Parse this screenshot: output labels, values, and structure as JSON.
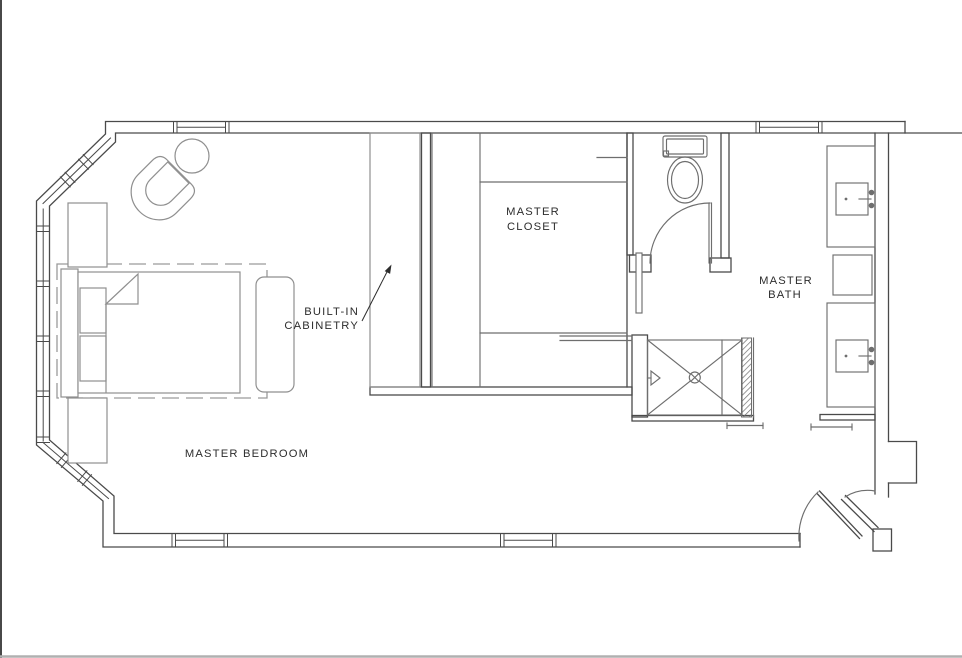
{
  "drawing": {
    "type": "architectural floor plan",
    "rooms": [
      {
        "name": "master-bedroom",
        "label": "MASTER BEDROOM"
      },
      {
        "name": "master-closet",
        "line1": "MASTER",
        "line2": "CLOSET"
      },
      {
        "name": "master-bath",
        "line1": "MASTER",
        "line2": "BATH"
      }
    ],
    "callouts": [
      {
        "name": "built-in-cabinetry",
        "line1": "BUILT-IN",
        "line2": "CABINETRY"
      }
    ],
    "fixtures": [
      "bay-window",
      "bed",
      "pillows",
      "headboard",
      "bench",
      "nightstand",
      "armchair",
      "ottoman",
      "area-rug",
      "built-in-cabinetry",
      "closet-shelving",
      "toilet",
      "wc-door",
      "pocket-door-panel",
      "shower",
      "shower-head",
      "shower-drain",
      "glass-panel",
      "vanity-sink",
      "faucet",
      "stool",
      "towel-bar",
      "entry-double-door"
    ],
    "colors": {
      "background": "#ffffff",
      "wall_line": "#4a4a4a",
      "fixture_line": "#6e6e6e",
      "furniture_line": "#8f8f8f",
      "rug_dash": "#9a9a9a",
      "text": "#2d2d2d",
      "page_edge_left": "#1a1a1a",
      "page_edge_bottom": "#b0b0b0"
    }
  }
}
